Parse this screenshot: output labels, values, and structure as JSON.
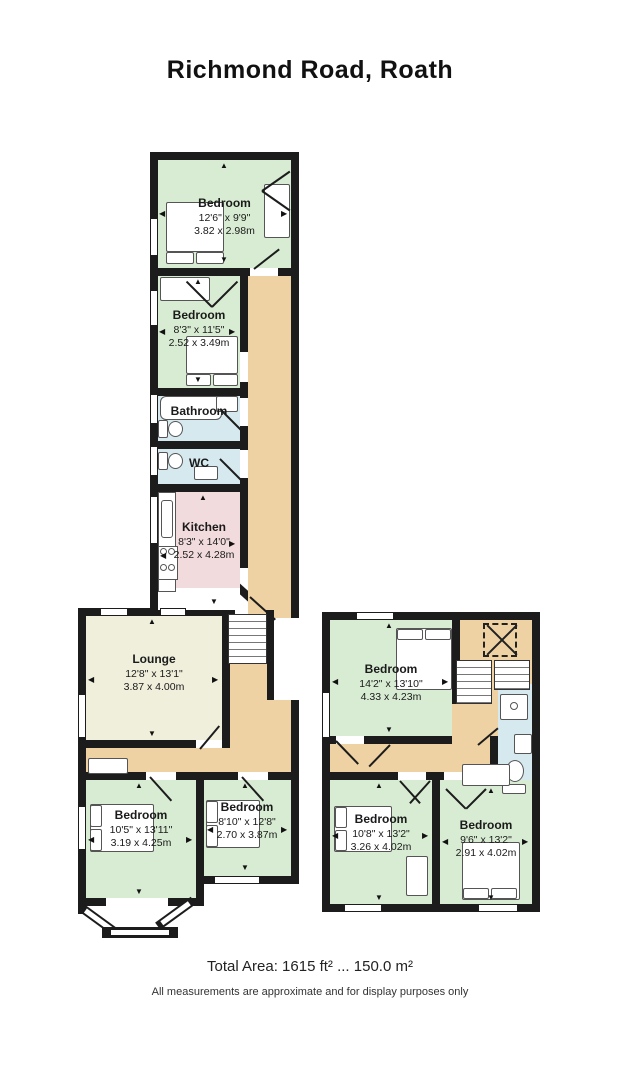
{
  "title": "Richmond Road, Roath",
  "rooms": {
    "bedroom1": {
      "name": "Bedroom",
      "ft": "12'6\" x 9'9\"",
      "m": "3.82 x 2.98m"
    },
    "bedroom2": {
      "name": "Bedroom",
      "ft": "8'3\" x 11'5\"",
      "m": "2.52 x 3.49m"
    },
    "bathroom": {
      "name": "Bathroom"
    },
    "wc": {
      "name": "WC"
    },
    "kitchen": {
      "name": "Kitchen",
      "ft": "8'3\" x 14'0\"",
      "m": "2.52 x 4.28m"
    },
    "lounge": {
      "name": "Lounge",
      "ft": "12'8\" x 13'1\"",
      "m": "3.87 x 4.00m"
    },
    "bedroom3": {
      "name": "Bedroom",
      "ft": "10'5\" x 13'11\"",
      "m": "3.19 x 4.25m"
    },
    "bedroom4": {
      "name": "Bedroom",
      "ft": "8'10\" x 12'8\"",
      "m": "2.70 x 3.87m"
    },
    "bedroom5": {
      "name": "Bedroom",
      "ft": "14'2\" x 13'10\"",
      "m": "4.33 x 4.23m"
    },
    "bedroom6": {
      "name": "Bedroom",
      "ft": "10'8\" x 13'2\"",
      "m": "3.26 x 4.02m"
    },
    "bedroom7": {
      "name": "Bedroom",
      "ft": "9'6\" x 13'2\"",
      "m": "2.91 x 4.02m"
    }
  },
  "footer": {
    "total_area": "Total Area: 1615 ft² ... 150.0 m²",
    "disclaimer": "All measurements are approximate and for display purposes only"
  },
  "colors": {
    "wall": "#1c1c1c",
    "room_green": "#d8ecd3",
    "hall_tan": "#eed2a4",
    "kitchen_pink": "#f2dbdd",
    "bath_blue": "#d5e9ee",
    "lounge_cream": "#f0efdc"
  }
}
